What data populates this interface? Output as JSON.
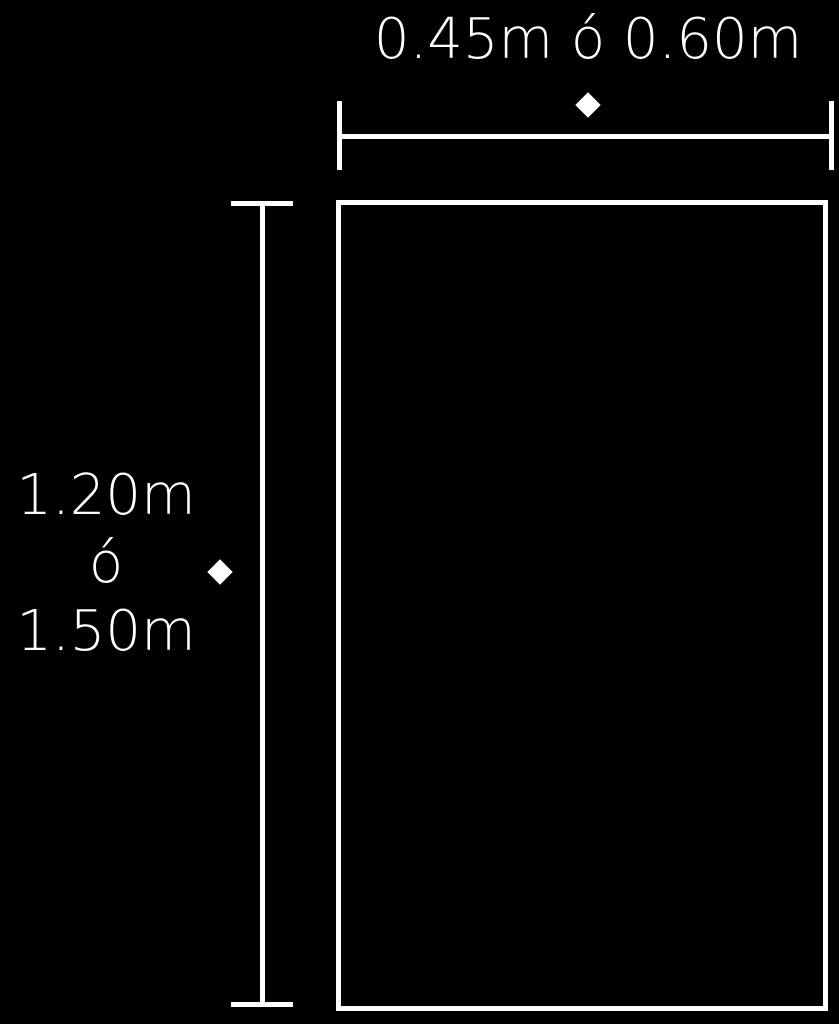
{
  "diagram": {
    "shape": "rectangle",
    "colors": {
      "background": "#000000",
      "foreground": "#ffffff"
    },
    "width_dimension": {
      "label": "0.45m ó 0.60m",
      "marker": "diamond"
    },
    "height_dimension": {
      "label_lines": [
        "1.20m",
        "ó",
        "1.50m"
      ],
      "marker": "diamond"
    }
  }
}
